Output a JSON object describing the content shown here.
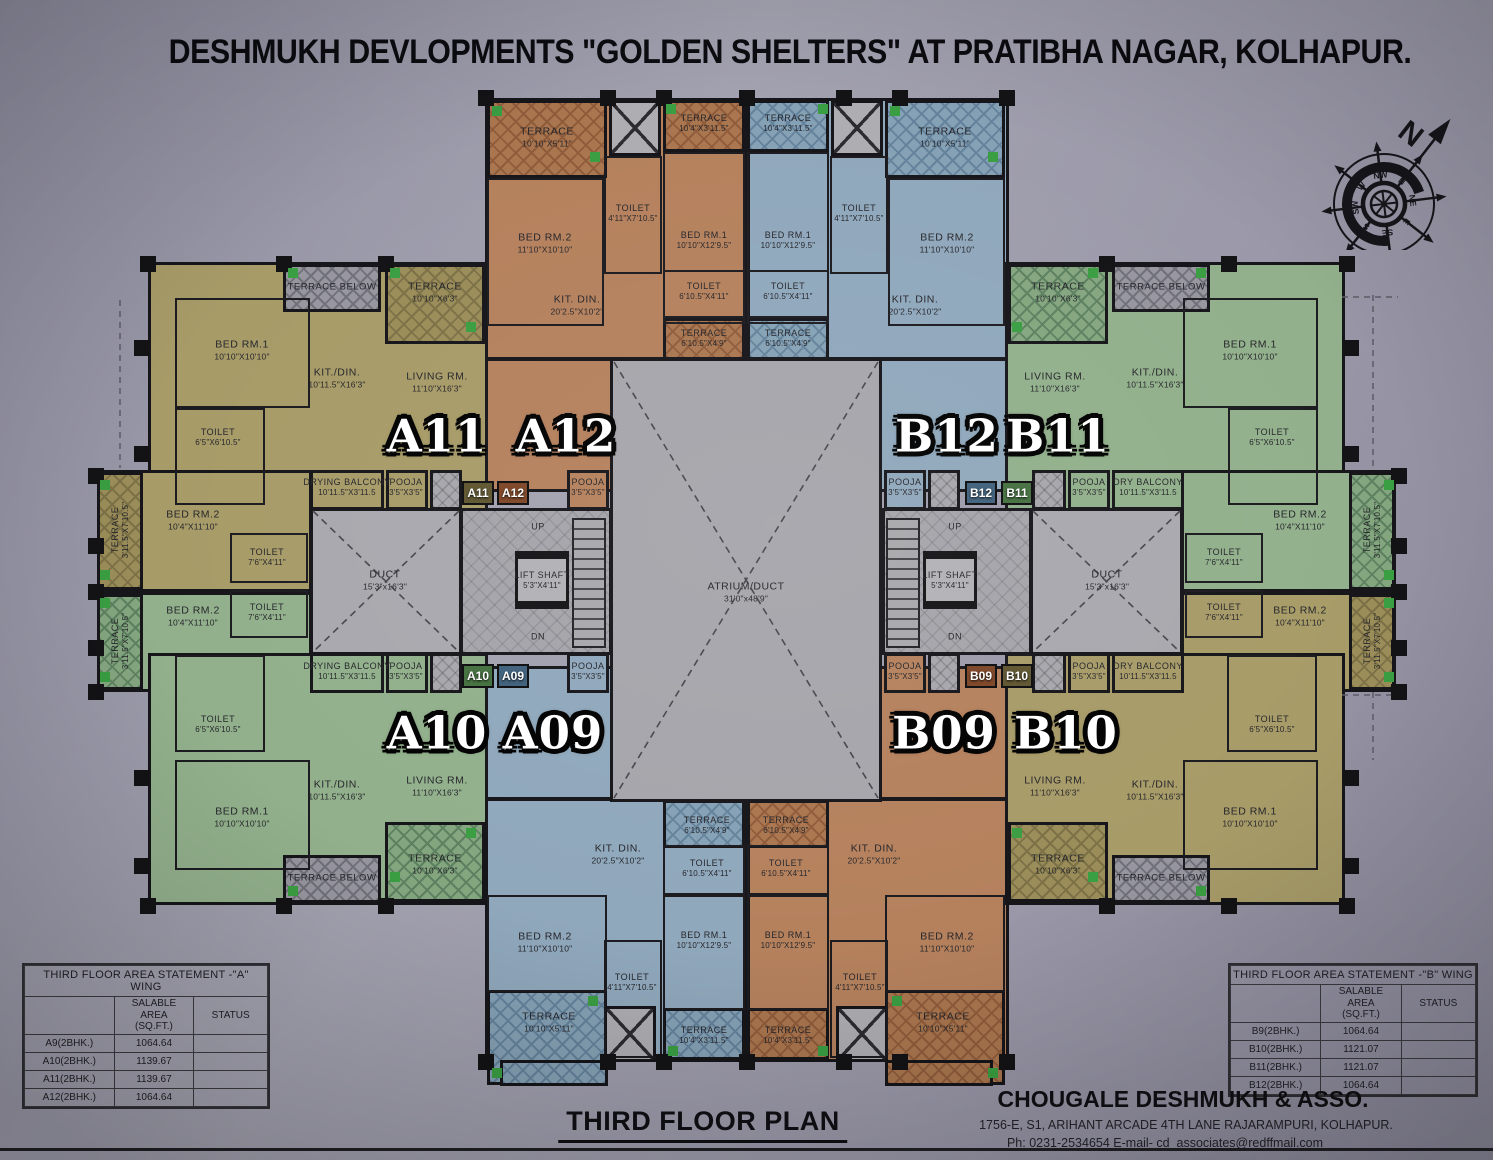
{
  "title": "DESHMUKH DEVLOPMENTS \"GOLDEN SHELTERS\" AT PRATIBHA NAGAR, KOLHAPUR.",
  "compass": {
    "north": "N",
    "points": [
      "N",
      "NE",
      "E",
      "SE",
      "S",
      "SW",
      "W",
      "NW"
    ]
  },
  "units": {
    "a11": "A11",
    "a12": "A12",
    "b12": "B12",
    "b11": "B11",
    "a10": "A10",
    "a09": "A09",
    "b09": "B09",
    "b10": "B10"
  },
  "core": {
    "duct_name": "DUCT",
    "duct_dims": "15'3\"x16'3\"",
    "lift_name": "LIFT SHAFT",
    "lift_dims": "5'3\"X4'11\"",
    "atrium_name": "ATRIUM/DUCT",
    "atrium_dims": "31'0\"x48'9\"",
    "up": "UP",
    "dn": "DN"
  },
  "room_types": {
    "bed1_sq": {
      "name": "BED RM.1",
      "dims": "10'10\"X10'10\""
    },
    "bed1_lg": {
      "name": "BED RM.1",
      "dims": "10'10\"X12'9.5\""
    },
    "bed2_lg": {
      "name": "BED RM.2",
      "dims": "11'10\"X10'10\""
    },
    "bed2_sd": {
      "name": "BED RM.2",
      "dims": "10'4\"X11'10\""
    },
    "kitdin_c": {
      "name": "KIT. DIN.",
      "dims": "20'2.5\"X10'2\""
    },
    "kitdin_w": {
      "name": "KIT./DIN.",
      "dims": "10'11.5\"X16'3\""
    },
    "living": {
      "name": "LIVING RM.",
      "dims": "11'10\"X16'3\""
    },
    "toilet_a": {
      "name": "TOILET",
      "dims": "4'11\"X7'10.5\""
    },
    "toilet_b": {
      "name": "TOILET",
      "dims": "6'10.5\"X4'11\""
    },
    "toilet_c": {
      "name": "TOILET",
      "dims": "6'5\"X6'10.5\""
    },
    "toilet_d": {
      "name": "TOILET",
      "dims": "7'6\"X4'11\""
    },
    "terrace_a": {
      "name": "TERRACE",
      "dims": "10'10\"X5'11\""
    },
    "terrace_b": {
      "name": "TERRACE",
      "dims": "10'4\"X3'11.5\""
    },
    "terrace_c": {
      "name": "TERRACE",
      "dims": "6'10.5\"X4'9\""
    },
    "terrace_d": {
      "name": "TERRACE",
      "dims": "10'10\"X6'3\""
    },
    "terrace_v": {
      "name": "TERRACE",
      "dims": "3'11.5\"X7'10.5\""
    },
    "terrace_below": {
      "name": "TERRACE BELOW"
    },
    "drying_balcony": {
      "name": "DRYING BALCONY",
      "dims": "10'11.5\"X3'11.5"
    },
    "dry_balcony": {
      "name": "DRY BALCONY",
      "dims": "10'11.5\"X3'11.5"
    },
    "pooja": {
      "name": "POOJA",
      "dims": "3'5\"X3'5\""
    }
  },
  "tables": {
    "a_wing": {
      "title": "THIRD FLOOR AREA STATEMENT -\"A\" WING",
      "col_unit": "",
      "col_area_line1": "SALABLE AREA",
      "col_area_line2": "(SQ.FT.)",
      "col_status": "STATUS",
      "rows": [
        {
          "unit": "A9(2BHK.)",
          "area": "1064.64",
          "status": ""
        },
        {
          "unit": "A10(2BHK.)",
          "area": "1139.67",
          "status": ""
        },
        {
          "unit": "A11(2BHK.)",
          "area": "1139.67",
          "status": ""
        },
        {
          "unit": "A12(2BHK.)",
          "area": "1064.64",
          "status": ""
        }
      ]
    },
    "b_wing": {
      "title": "THIRD FLOOR AREA STATEMENT -\"B\" WING",
      "col_unit": "",
      "col_area_line1": "SALABLE AREA",
      "col_area_line2": "(SQ.FT.)",
      "col_status": "STATUS",
      "rows": [
        {
          "unit": "B9(2BHK.)",
          "area": "1064.64",
          "status": ""
        },
        {
          "unit": "B10(2BHK.)",
          "area": "1121.07",
          "status": ""
        },
        {
          "unit": "B11(2BHK.)",
          "area": "1121.07",
          "status": ""
        },
        {
          "unit": "B12(2BHK.)",
          "area": "1064.64",
          "status": ""
        }
      ]
    }
  },
  "footer": {
    "plan_title": "THIRD FLOOR PLAN",
    "firm": "CHOUGALE DESHMUKH & ASSO.",
    "address": "1756-E, S1, ARIHANT ARCADE 4TH LANE RAJARAMPURI, KOLHAPUR.",
    "contact": "Ph: 0231-2534654   E-mail- cd_associates@redffmail.com"
  }
}
